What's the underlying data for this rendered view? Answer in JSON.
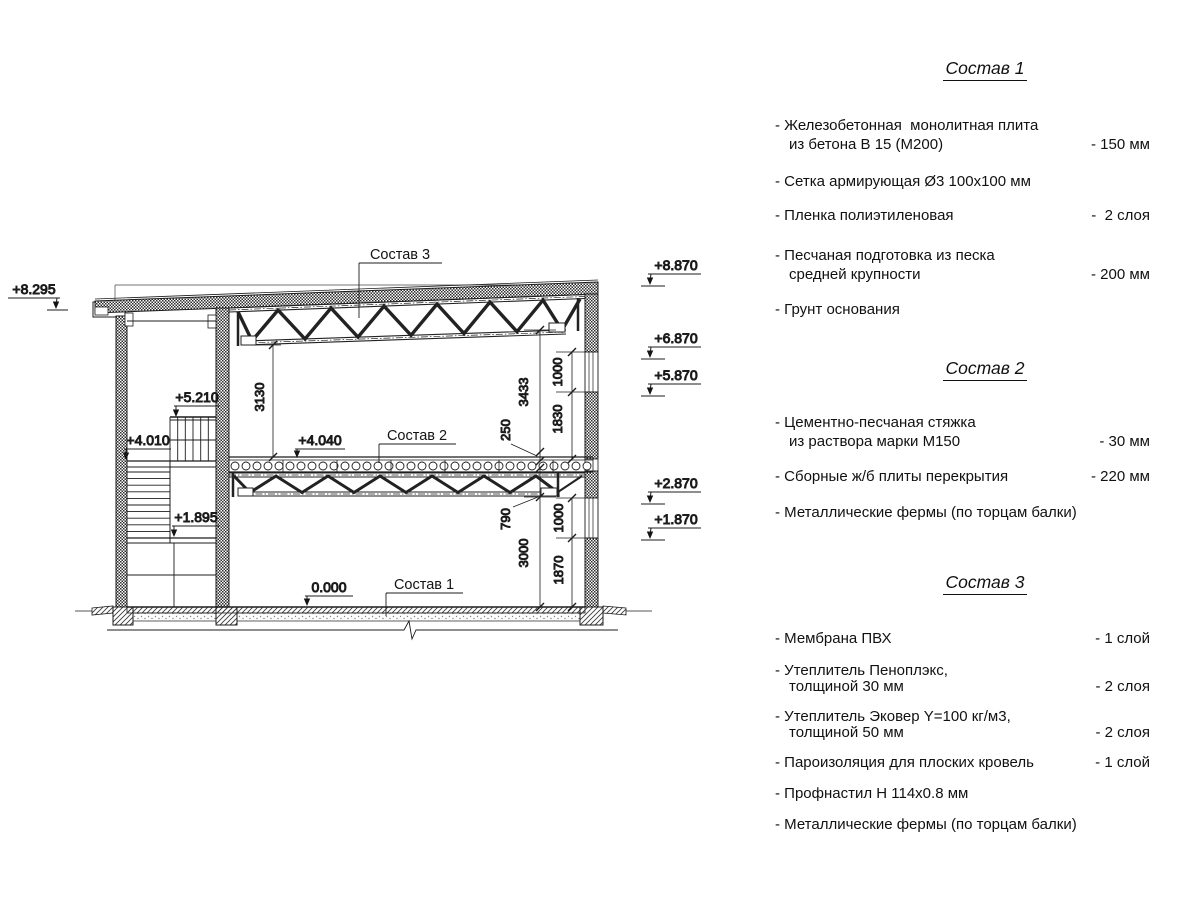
{
  "drawing": {
    "labels": {
      "sostav1": "Состав 1",
      "sostav2": "Состав 2",
      "sostav3": "Состав 3"
    },
    "elevations": {
      "eave": "+8.295",
      "roof": "+8.870",
      "truss_bottom": "+6.870",
      "win_top": "+5.870",
      "floor2_win": "+2.870",
      "win_low": "+1.870",
      "stair_rail": "+5.210",
      "landing": "+4.010",
      "mid_landing": "+1.895",
      "floor2": "+4.040",
      "ground": "0.000"
    },
    "dimensions": {
      "left_clear": "3130",
      "right_clear": "3433",
      "slab_thick": "250",
      "win_upper": "1000",
      "parapet2": "1830",
      "truss2_depth": "790",
      "lower_clear": "3000",
      "win_lower": "1000",
      "sill": "1870"
    },
    "colors": {
      "ink": "#141414",
      "background": "#ffffff"
    }
  },
  "panel": {
    "sections": [
      {
        "title": "Состав 1",
        "items": [
          {
            "line1": "- Железобетонная  монолитная плита",
            "line2": "из бетона В 15 (М200)",
            "value": "- 150 мм"
          },
          {
            "line1": "- Сетка армирующая Ø3 100х100 мм"
          },
          {
            "line1": "- Пленка полиэтиленовая",
            "value": "-  2 слоя"
          },
          {
            "line1": "- Песчаная подготовка из песка",
            "line2": "средней крупности",
            "value": "- 200 мм"
          },
          {
            "line1": "- Грунт основания"
          }
        ]
      },
      {
        "title": "Состав 2",
        "items": [
          {
            "line1": "- Цементно-песчаная стяжка",
            "line2": "из раствора марки М150",
            "value": "- 30 мм"
          },
          {
            "line1": "- Сборные ж/б плиты перекрытия",
            "value": "- 220 мм"
          },
          {
            "line1": "- Металлические фермы (по торцам балки)"
          }
        ]
      },
      {
        "title": "Состав 3",
        "items": [
          {
            "line1": "- Мембрана ПВХ",
            "value": "- 1 слой"
          },
          {
            "line1": "- Утеплитель Пеноплэкс,",
            "line2": "толщиной 30 мм",
            "value": "- 2 слоя"
          },
          {
            "line1": "- Утеплитель Эковер Y=100 кг/м3,",
            "line2": "толщиной 50 мм",
            "value": "- 2 слоя"
          },
          {
            "line1": "- Пароизоляция для плоских кровель",
            "value": "- 1 слой"
          },
          {
            "line1": "- Профнастил Н 114х0.8 мм"
          },
          {
            "line1": "- Металлические фермы (по торцам балки)"
          }
        ]
      }
    ]
  }
}
